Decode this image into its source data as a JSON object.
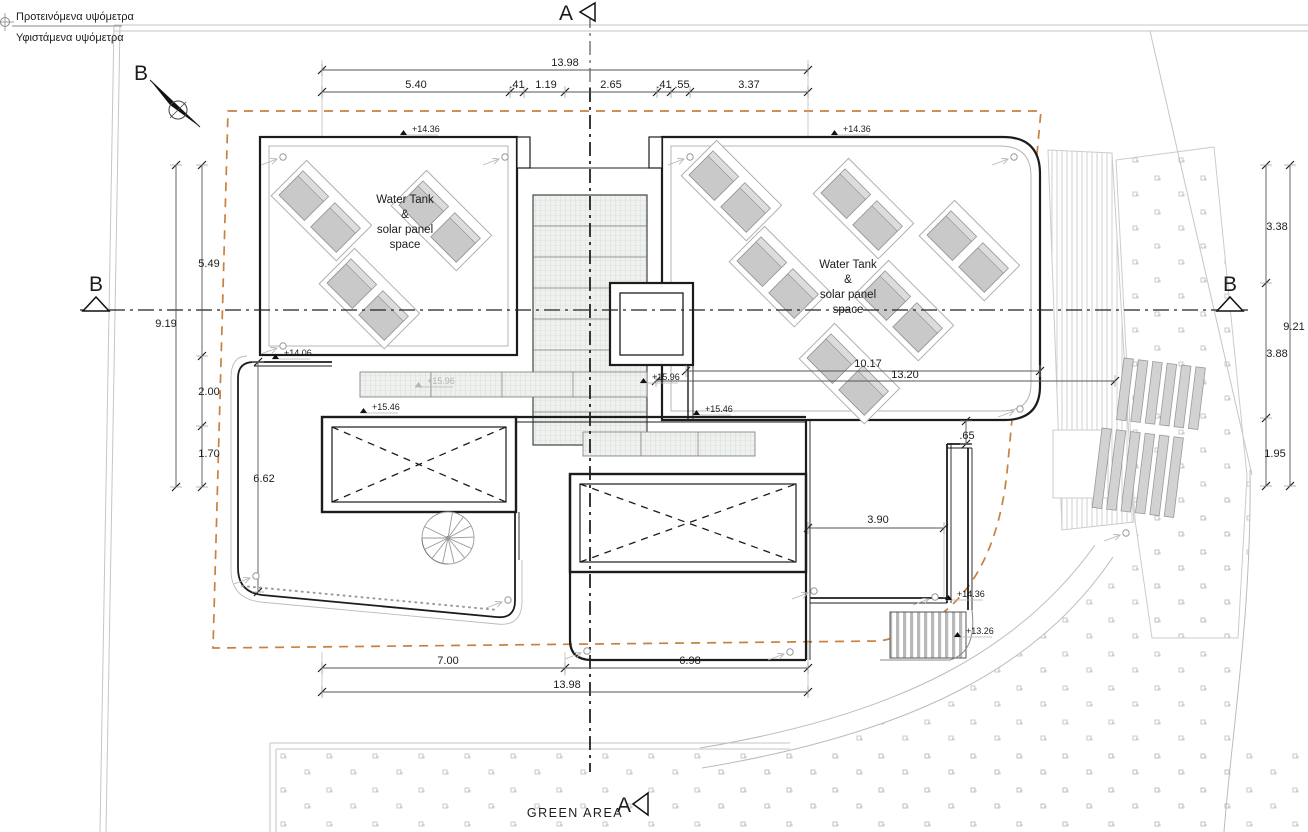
{
  "drawing_type": "roof / site plan",
  "colors": {
    "outline": "#1c1c1c",
    "light_line": "#bcbcbc",
    "setback_orange": "#c8813f",
    "panel_gray": "#c9c9c9",
    "hatch_fill": "#eef1ee"
  },
  "legend": {
    "proposed": "Προτεινόμενα υψόμετρα",
    "existing": "Υφιστάμενα υψόμετρα"
  },
  "labels": [
    {
      "n": "dim-top-total",
      "x": 565,
      "y": 66,
      "t": "13.98"
    },
    {
      "n": "dim-top-seg-1",
      "x": 416,
      "y": 88,
      "t": "5.40"
    },
    {
      "n": "dim-top-seg-2",
      "x": 517,
      "y": 88,
      "t": ".41"
    },
    {
      "n": "dim-top-seg-3",
      "x": 546,
      "y": 88,
      "t": "1.19"
    },
    {
      "n": "dim-top-seg-4",
      "x": 611,
      "y": 88,
      "t": "2.65"
    },
    {
      "n": "dim-top-seg-5",
      "x": 664,
      "y": 88,
      "t": ".41"
    },
    {
      "n": "dim-top-seg-6",
      "x": 682,
      "y": 88,
      "t": ".55"
    },
    {
      "n": "dim-top-seg-7",
      "x": 749,
      "y": 88,
      "t": "3.37"
    },
    {
      "n": "dim-left-seg-1",
      "x": 209,
      "y": 267,
      "t": "5.49"
    },
    {
      "n": "dim-left-total",
      "x": 166,
      "y": 327,
      "t": "9.19"
    },
    {
      "n": "dim-left-seg-2",
      "x": 209,
      "y": 395,
      "t": "2.00"
    },
    {
      "n": "dim-left-seg-3",
      "x": 209,
      "y": 457,
      "t": "1.70"
    },
    {
      "n": "dim-left-wall",
      "x": 264,
      "y": 482,
      "t": "6.62"
    },
    {
      "n": "dim-right-seg-1",
      "x": 1277,
      "y": 230,
      "t": "3.38"
    },
    {
      "n": "dim-right-total",
      "x": 1294,
      "y": 330,
      "t": "9.21"
    },
    {
      "n": "dim-right-seg-2",
      "x": 1277,
      "y": 357,
      "t": "3.88"
    },
    {
      "n": "dim-right-seg-3",
      "x": 1275,
      "y": 457,
      "t": "1.95"
    },
    {
      "n": "dim-roof-width",
      "x": 868,
      "y": 367,
      "t": "10.17"
    },
    {
      "n": "dim-roof-width-2",
      "x": 905,
      "y": 378,
      "t": "13.20"
    },
    {
      "n": "dim-parapet-offset",
      "x": 967,
      "y": 439,
      "t": ".65"
    },
    {
      "n": "dim-terrace-width",
      "x": 878,
      "y": 523,
      "t": "3.90"
    },
    {
      "n": "dim-bottom-left",
      "x": 448,
      "y": 664,
      "t": "7.00"
    },
    {
      "n": "dim-bottom-right",
      "x": 690,
      "y": 664,
      "t": "6.98"
    },
    {
      "n": "dim-bottom-total",
      "x": 567,
      "y": 688,
      "t": "13.98"
    },
    {
      "n": "elev-roof-left",
      "x": 412,
      "y": 132,
      "t": "+14.36",
      "c": "elev",
      "a": "start"
    },
    {
      "n": "elev-roof-right",
      "x": 843,
      "y": 132,
      "t": "+14.36",
      "c": "elev",
      "a": "start"
    },
    {
      "n": "elev-terrace-left",
      "x": 284,
      "y": 356,
      "t": "+14.06",
      "c": "elev",
      "a": "start"
    },
    {
      "n": "elev-pergola-1",
      "x": 427,
      "y": 384,
      "t": "+15.96",
      "c": "elev-light",
      "a": "start"
    },
    {
      "n": "elev-pergola-2",
      "x": 652,
      "y": 380,
      "t": "+15.96",
      "c": "elev",
      "a": "start"
    },
    {
      "n": "elev-parapet-1",
      "x": 372,
      "y": 410,
      "t": "+15.46",
      "c": "elev",
      "a": "start"
    },
    {
      "n": "elev-parapet-2",
      "x": 705,
      "y": 412,
      "t": "+15.46",
      "c": "elev",
      "a": "start"
    },
    {
      "n": "elev-terrace-right",
      "x": 957,
      "y": 597,
      "t": "+14.36",
      "c": "elev",
      "a": "start"
    },
    {
      "n": "elev-steps",
      "x": 966,
      "y": 634,
      "t": "+13.26",
      "c": "elev",
      "a": "start"
    },
    {
      "n": "watertank-left-1",
      "x": 405,
      "y": 203,
      "t": "Water Tank",
      "c": "wt"
    },
    {
      "n": "watertank-left-2",
      "x": 405,
      "y": 218,
      "t": "&",
      "c": "wt"
    },
    {
      "n": "watertank-left-3",
      "x": 405,
      "y": 233,
      "t": "solar panel",
      "c": "wt"
    },
    {
      "n": "watertank-left-4",
      "x": 405,
      "y": 248,
      "t": "space",
      "c": "wt"
    },
    {
      "n": "watertank-right-1",
      "x": 848,
      "y": 268,
      "t": "Water Tank",
      "c": "wt"
    },
    {
      "n": "watertank-right-2",
      "x": 848,
      "y": 283,
      "t": "&",
      "c": "wt"
    },
    {
      "n": "watertank-right-3",
      "x": 848,
      "y": 298,
      "t": "solar panel",
      "c": "wt"
    },
    {
      "n": "watertank-right-4",
      "x": 848,
      "y": 313,
      "t": "space",
      "c": "wt"
    },
    {
      "n": "green-area-label",
      "x": 575,
      "y": 817,
      "t": "GREEN AREA",
      "c": "green"
    },
    {
      "n": "legend-proposed",
      "x": 16,
      "y": 20,
      "t": "Προτεινόμενα υψόμετρα",
      "c": "legend",
      "a": "start"
    },
    {
      "n": "legend-existing",
      "x": 16,
      "y": 41,
      "t": "Υφιστάμενα υψόμετρα",
      "c": "legend",
      "a": "start"
    },
    {
      "n": "section-a-top",
      "x": 566,
      "y": 20,
      "t": "A",
      "c": "sec"
    },
    {
      "n": "section-a-bottom",
      "x": 624,
      "y": 812,
      "t": "A",
      "c": "sec"
    },
    {
      "n": "section-b-left",
      "x": 96,
      "y": 291,
      "t": "B",
      "c": "sec"
    },
    {
      "n": "section-b-right",
      "x": 1230,
      "y": 291,
      "t": "B",
      "c": "sec"
    },
    {
      "n": "north-label",
      "x": 141,
      "y": 80,
      "t": "B",
      "c": "sec"
    }
  ]
}
